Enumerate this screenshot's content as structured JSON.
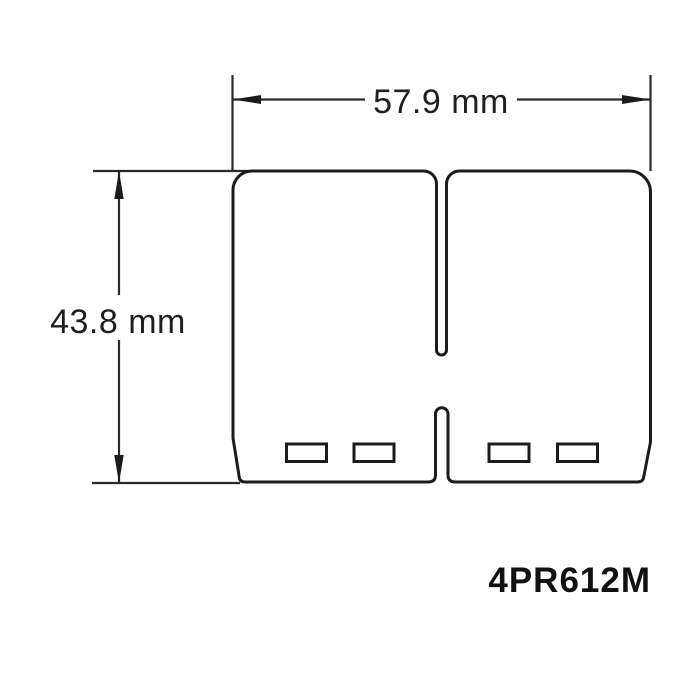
{
  "drawing": {
    "part_number": "4PR612M",
    "width_dimension": {
      "label": "57.9 mm",
      "value": 57.9,
      "unit": "mm"
    },
    "height_dimension": {
      "label": "43.8 mm",
      "value": 43.8,
      "unit": "mm"
    },
    "bottom_slot_count": 4,
    "colors": {
      "line": "#1b1b1b",
      "background": "#ffffff"
    }
  }
}
